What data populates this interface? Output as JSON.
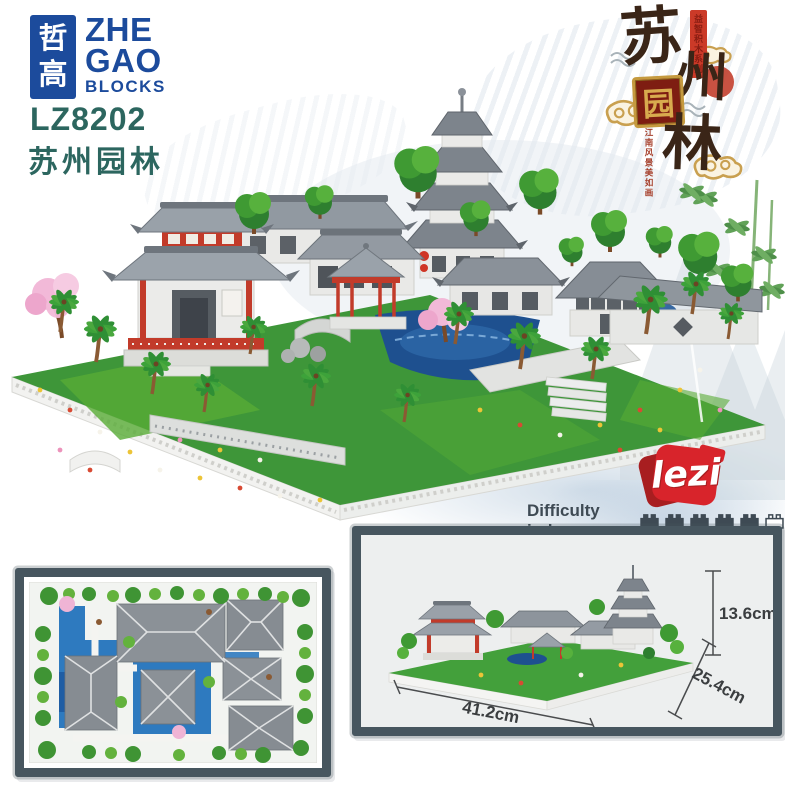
{
  "brand": {
    "box_char_top": "哲",
    "box_char_bottom": "高",
    "line1": "ZHE",
    "line2": "GAO",
    "line3": "BLOCKS"
  },
  "product": {
    "model": "LZ8202",
    "name_cn": "苏州园林"
  },
  "hero": {
    "series_banner": "益智积木系列",
    "char_1": "苏",
    "char_2": "州",
    "char_3": "园",
    "char_4": "林",
    "tagline": "江南风景美如画"
  },
  "lezi": {
    "text": "lezi"
  },
  "difficulty": {
    "label": "Difficulty index:",
    "filled": 5,
    "total": 6
  },
  "dims": {
    "height": "13.6cm",
    "length": "41.2cm",
    "depth": "25.4cm"
  },
  "colors": {
    "brand_blue": "#1c4b9c",
    "title_teal": "#2c665f",
    "calligraphy_ink": "#3a2517",
    "seal_red": "#c23a28",
    "gold": "#c9a050",
    "lezi_red": "#d8242b",
    "frame_slate": "#47565f",
    "brick_slate": "#3e4a54",
    "base_green": "#3e9639",
    "water_blue": "#1e508f"
  }
}
